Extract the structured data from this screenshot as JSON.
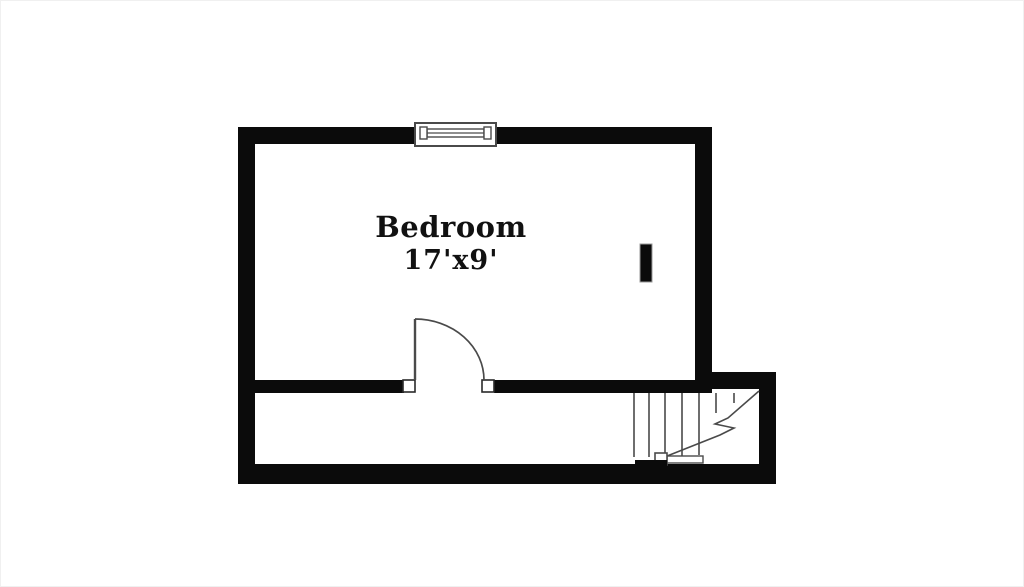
{
  "floorplan": {
    "room": {
      "name": "Bedroom",
      "dimensions": "17'x9'"
    },
    "symbols": {
      "window": "window-symbol",
      "door": "door-swing-symbol",
      "stairs": "staircase-symbol",
      "column": "column-marker"
    },
    "colors": {
      "wall": "#0b0b0b",
      "line": "#4a4a4a",
      "text": "#111111",
      "background": "#ffffff"
    }
  }
}
